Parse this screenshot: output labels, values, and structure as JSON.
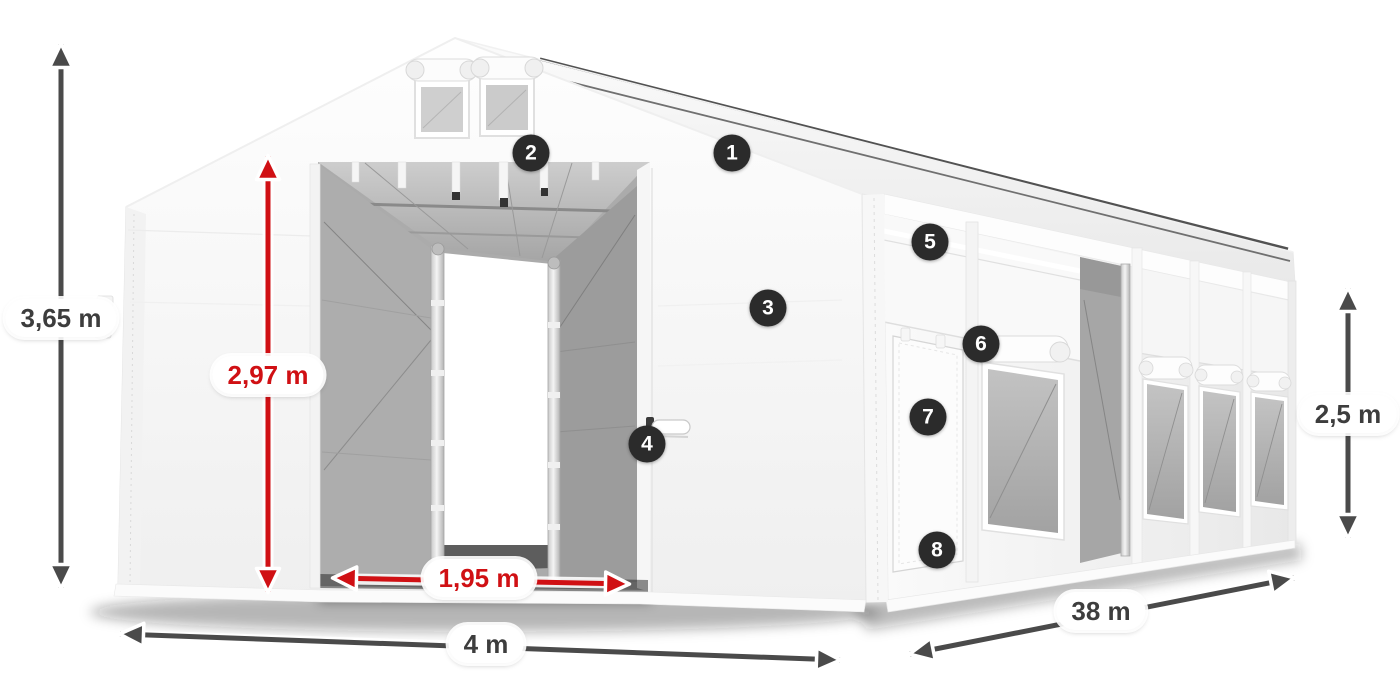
{
  "page": {
    "title": "Tent dimensions diagram",
    "background": "#ffffff"
  },
  "colors": {
    "dimension_red": "#d01014",
    "dimension_dark": "#4a4a4a",
    "badge_background": "#2b2b2b",
    "badge_text": "#ffffff",
    "pill_background": "#ffffff",
    "pill_text": "#3d3d3d"
  },
  "diagram": {
    "subject": "White tarpaulin storage tent with open gable entrance, roof vents, side door and mesh side windows",
    "measurements": {
      "total_height": {
        "label": "3,65 m",
        "style": "dark"
      },
      "entrance_height": {
        "label": "2,97 m",
        "style": "red"
      },
      "entrance_width": {
        "label": "1,95 m",
        "style": "red"
      },
      "width": {
        "label": "4 m",
        "style": "dark"
      },
      "length": {
        "label": "38 m",
        "style": "dark"
      },
      "side_height": {
        "label": "2,5 m",
        "style": "dark"
      }
    },
    "callouts": [
      {
        "number": "1"
      },
      {
        "number": "2"
      },
      {
        "number": "3"
      },
      {
        "number": "4"
      },
      {
        "number": "5"
      },
      {
        "number": "6"
      },
      {
        "number": "7"
      },
      {
        "number": "8"
      }
    ]
  }
}
